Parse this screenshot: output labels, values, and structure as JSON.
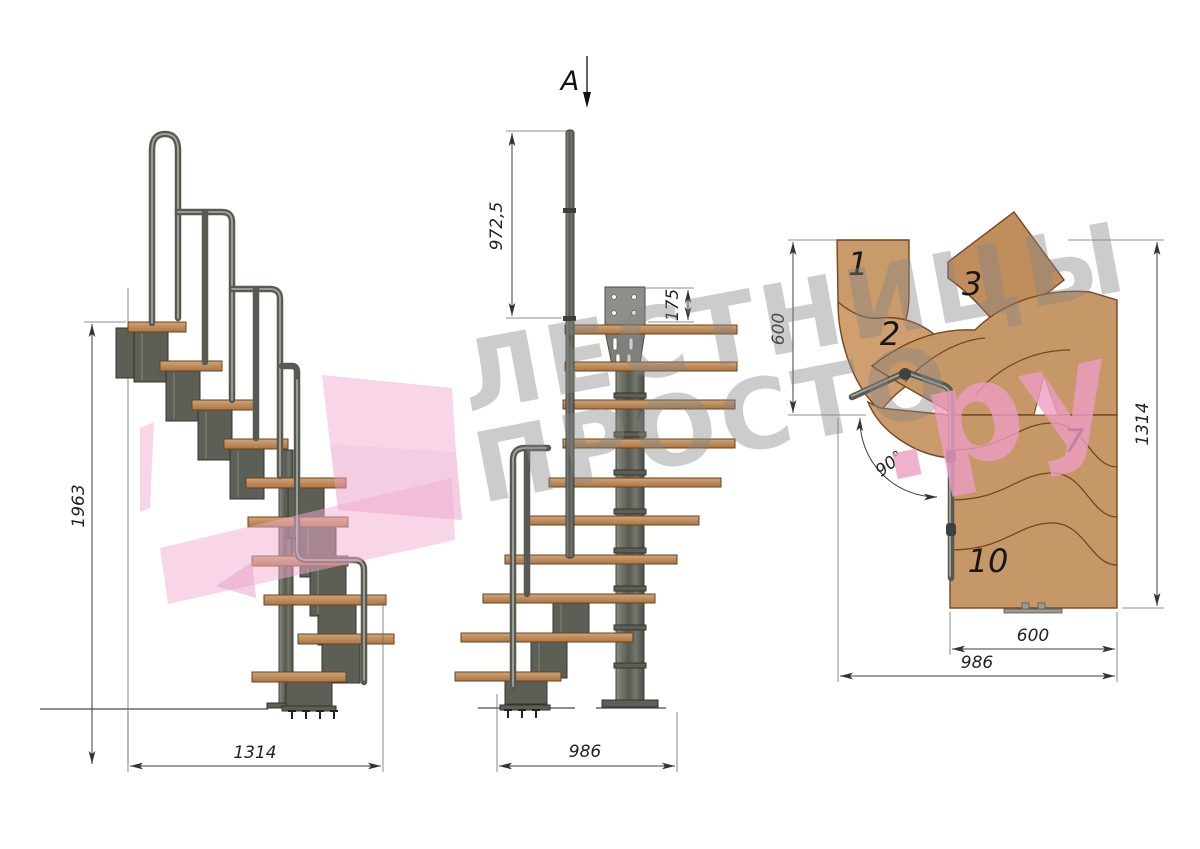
{
  "section_marker": {
    "label": "A"
  },
  "side_view": {
    "dim_height_mm": "1963",
    "dim_depth_mm": "1314"
  },
  "front_view": {
    "dim_handrail_mm": "972,5",
    "dim_plate_mm": "175",
    "dim_width_mm": "986"
  },
  "plan_view": {
    "dim_turn_mm": "600",
    "dim_length_mm": "1314",
    "dim_angle": "90°",
    "dim_step_width_mm": "600",
    "dim_total_mm": "986",
    "step_numbers": [
      "1",
      "2",
      "3",
      "7",
      "10"
    ]
  },
  "watermark": {
    "line1": "ЛЕСТНИЦЫ",
    "line2": "ПРОСТО",
    "suffix": ".ру"
  },
  "colors": {
    "wood": "#c69868",
    "wood_edge": "#76461f",
    "metal": "#5c5f55",
    "dimension": "#3c3c3c",
    "watermark_gray": "#858585",
    "watermark_pink": "#ec9dc3"
  }
}
